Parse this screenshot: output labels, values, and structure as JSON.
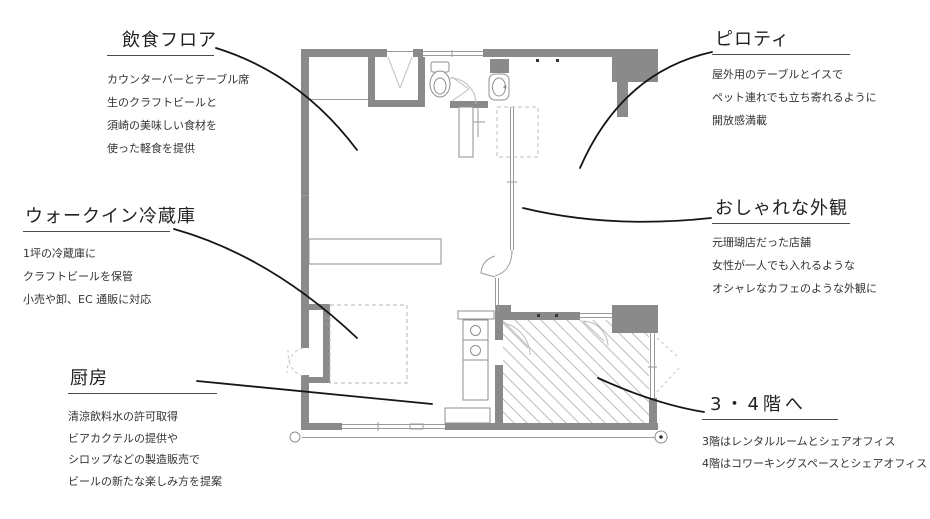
{
  "page": {
    "background": "#ffffff"
  },
  "colors": {
    "wall": "#8a8a8a",
    "thin_line": "#9a9a9a",
    "door_line": "#bdbdbd",
    "hatch": "#bdbdbd",
    "dashed": "#b5b5b5",
    "leader": "#151515",
    "text": "#2a2a2a"
  },
  "plan_features": [
    "toilet-fixture",
    "hand-sink-fixture",
    "kitchen-sink-counter",
    "dining-counter",
    "walk-in-fridge-outline",
    "staircase-hatched-area",
    "piloti-column",
    "storefront-glass-wall",
    "entry-door",
    "window-bands"
  ],
  "annotations": [
    {
      "id": "dining-floor",
      "title": "飲食フロア",
      "lines": [
        "カウンターバーとテーブル席",
        "生のクラフトビールと",
        "須崎の美味しい食材を",
        "使った軽食を提供"
      ]
    },
    {
      "id": "piloti",
      "title": "ピロティ",
      "lines": [
        "屋外用のテーブルとイスで",
        "ペット連れでも立ち寄れるように",
        "開放感満載"
      ]
    },
    {
      "id": "walkin-fridge",
      "title": "ウォークイン冷蔵庫",
      "lines": [
        "1坪の冷蔵庫に",
        "クラフトビールを保管",
        "小売や卸、EC 通販に対応"
      ]
    },
    {
      "id": "stylish-facade",
      "title": "おしゃれな外観",
      "lines": [
        "元珊瑚店だった店舗",
        "女性が一人でも入れるような",
        "オシャレなカフェのような外観に"
      ]
    },
    {
      "id": "kitchen",
      "title": "厨房",
      "lines": [
        "清涼飲料水の許可取得",
        "ビアカクテルの提供や",
        "シロップなどの製造販売で",
        "ビールの新たな楽しみ方を提案"
      ]
    },
    {
      "id": "stairs-3-4f",
      "title": "3・4階へ",
      "lines": [
        "3階はレンタルルームとシェアオフィス",
        "4階はコワーキングスペースとシェアオフィス"
      ]
    }
  ]
}
